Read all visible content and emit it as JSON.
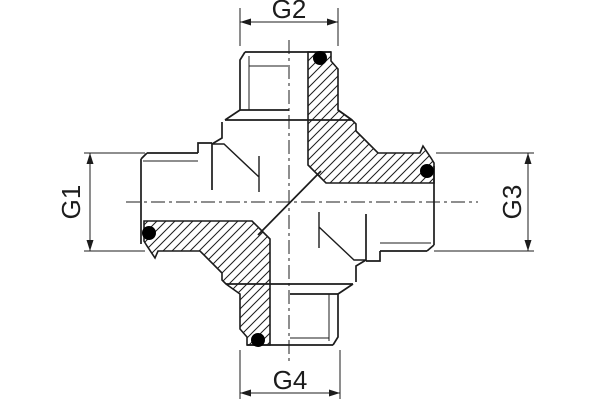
{
  "title": "cross-fitting-half-section-drawing",
  "background": "#ffffff",
  "line_color": "#1c1c1c",
  "seal_ring_color": "#000000",
  "dims": {
    "g1": {
      "label": "G1",
      "position": "left"
    },
    "g2": {
      "label": "G2",
      "position": "top"
    },
    "g3": {
      "label": "G3",
      "position": "right"
    },
    "g4": {
      "label": "G4",
      "position": "bottom"
    }
  }
}
